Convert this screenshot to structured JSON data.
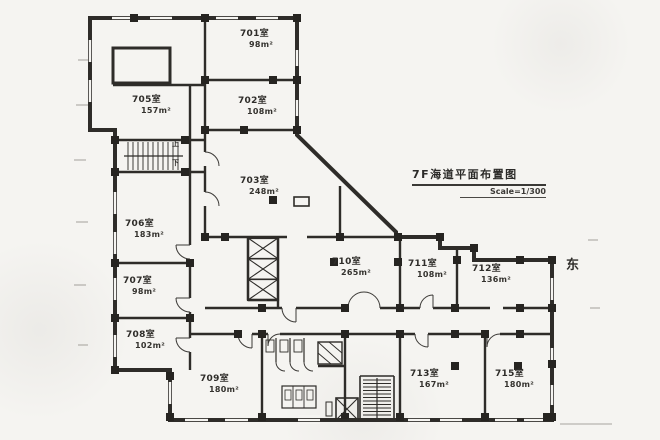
{
  "drawing": {
    "title": "7F海道平面布置图",
    "scale": "Scale=1/300",
    "east_marker": "东",
    "stair_up": "上",
    "stair_down": "下"
  },
  "rooms": [
    {
      "number": "701室",
      "area": "98m²"
    },
    {
      "number": "702室",
      "area": "108m²"
    },
    {
      "number": "703室",
      "area": "248m²"
    },
    {
      "number": "705室",
      "area": "157m²"
    },
    {
      "number": "706室",
      "area": "183m²"
    },
    {
      "number": "707室",
      "area": "98m²"
    },
    {
      "number": "708室",
      "area": "102m²"
    },
    {
      "number": "709室",
      "area": "180m²"
    },
    {
      "number": "710室",
      "area": "265m²"
    },
    {
      "number": "711室",
      "area": "108m²"
    },
    {
      "number": "712室",
      "area": "136m²"
    },
    {
      "number": "713室",
      "area": "167m²"
    },
    {
      "number": "715室",
      "area": "180m²"
    }
  ],
  "colors": {
    "ink": "#2e2c29",
    "paper": "#f5f4f1"
  }
}
